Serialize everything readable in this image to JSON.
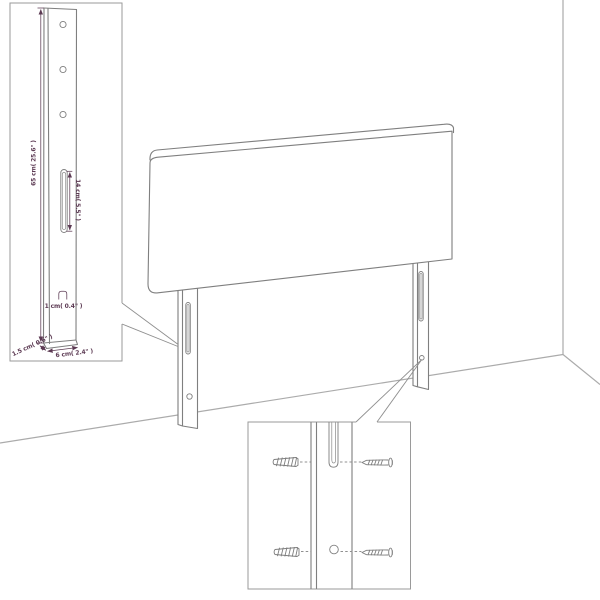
{
  "colors": {
    "background": "#ffffff",
    "line_art": "#7f7f7f",
    "wall_line": "#ababab",
    "inset_border": "#9a9a9a",
    "dimension_text": "#5c3a53"
  },
  "leg_detail_inset": {
    "labels": {
      "height": "65 cm( 25.6\" )",
      "slot_length": "14 cm( 5.5\" )",
      "slot_width": "1 cm( 0.4\" )",
      "side_thickness": "1.5 cm( 0.6\" )",
      "width": "6 cm( 2.4\" )"
    },
    "hole_count": "3"
  },
  "hardware_inset": {
    "icons": [
      "wall-plug-icon",
      "screw-icon"
    ],
    "wall_plug_count": "2",
    "screw_count": "2"
  }
}
